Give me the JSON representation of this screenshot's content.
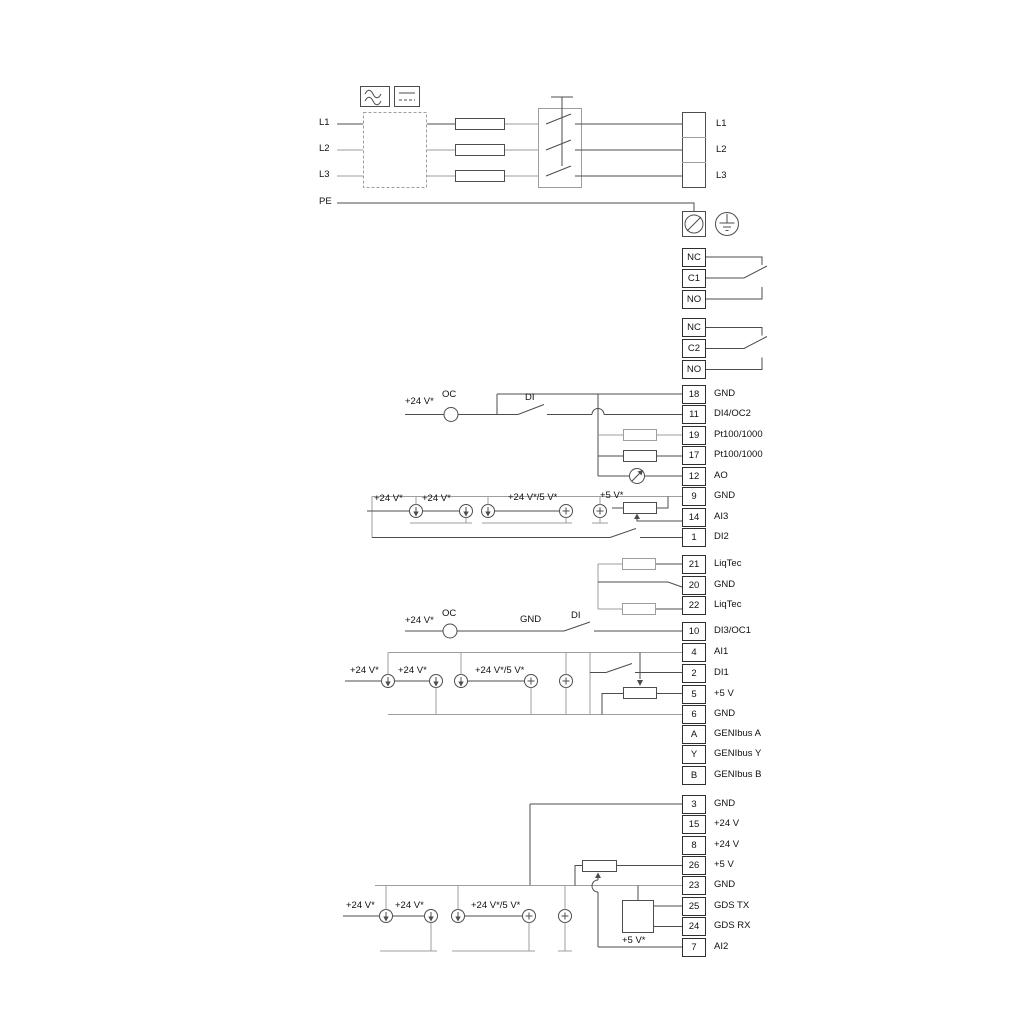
{
  "power": {
    "inputs": {
      "l1": "L1",
      "l2": "L2",
      "l3": "L3",
      "pe": "PE"
    },
    "outputs": {
      "l1": "L1",
      "l2": "L2",
      "l3": "L3"
    }
  },
  "relays": {
    "relay1": [
      "NC",
      "C1",
      "NO"
    ],
    "relay2": [
      "NC",
      "C2",
      "NO"
    ]
  },
  "terminals": {
    "io1": [
      {
        "id": "18",
        "label": "GND"
      },
      {
        "id": "11",
        "label": "DI4/OC2"
      },
      {
        "id": "19",
        "label": "Pt100/1000"
      },
      {
        "id": "17",
        "label": "Pt100/1000"
      },
      {
        "id": "12",
        "label": "AO"
      },
      {
        "id": "9",
        "label": "GND"
      },
      {
        "id": "14",
        "label": "AI3"
      },
      {
        "id": "1",
        "label": "DI2"
      }
    ],
    "liqtec": [
      {
        "id": "21",
        "label": "LiqTec"
      },
      {
        "id": "20",
        "label": "GND"
      },
      {
        "id": "22",
        "label": "LiqTec"
      }
    ],
    "io2": [
      {
        "id": "10",
        "label": "DI3/OC1"
      },
      {
        "id": "4",
        "label": "AI1"
      },
      {
        "id": "2",
        "label": "DI1"
      },
      {
        "id": "5",
        "label": "+5 V"
      },
      {
        "id": "6",
        "label": "GND"
      },
      {
        "id": "A",
        "label": "GENIbus A"
      },
      {
        "id": "Y",
        "label": "GENIbus Y"
      },
      {
        "id": "B",
        "label": "GENIbus B"
      }
    ],
    "io3": [
      {
        "id": "3",
        "label": "GND"
      },
      {
        "id": "15",
        "label": "+24 V"
      },
      {
        "id": "8",
        "label": "+24 V"
      },
      {
        "id": "26",
        "label": "+5 V"
      },
      {
        "id": "23",
        "label": "GND"
      },
      {
        "id": "25",
        "label": "GDS TX"
      },
      {
        "id": "24",
        "label": "GDS RX"
      },
      {
        "id": "7",
        "label": "AI2"
      }
    ]
  },
  "wire_labels": {
    "v24": "+24 V*",
    "v24_5": "+24 V*/5 V*",
    "v5": "+5 V*",
    "oc": "OC",
    "di": "DI",
    "gnd": "GND"
  },
  "icons": {
    "ac": "sine-wave-icon",
    "dc": "dc-line-icon",
    "fuse": "fuse-icon",
    "switch": "main-switch-icon",
    "screw": "cable-clamp-icon",
    "earth": "protective-earth-icon",
    "current_source": "current-source-icon",
    "plus_source": "voltage-source-icon",
    "resistor": "resistor-icon",
    "meter": "analog-meter-icon",
    "pot": "potentiometer-icon",
    "gds": "gds-sensor-icon",
    "relay": "changeover-contact-icon",
    "open_collector": "open-collector-icon"
  },
  "colors": {
    "wire_dark": "#4d4d4d",
    "wire_gray": "#9e9e9e",
    "text": "#111111",
    "background": "#ffffff"
  }
}
